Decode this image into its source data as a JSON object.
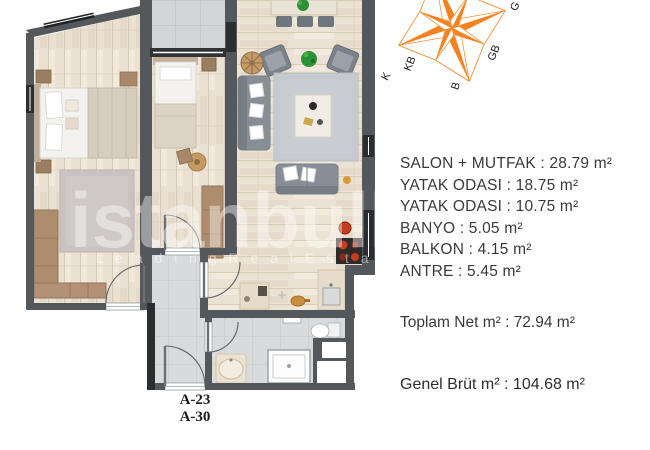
{
  "window": {
    "width": 650,
    "height": 450,
    "background": "#ffffff"
  },
  "floor_plan": {
    "unit_label_line1": "A-23",
    "unit_label_line2": "A-30",
    "watermark_line1": "istanbulh",
    "watermark_line2": "L e a d i n g   R e a l   E s t a",
    "colors": {
      "wall": "#53585c",
      "wall_dark": "#2b2e30",
      "wood_floor": "#ebe1d2",
      "balcony_tile": "#d3d4d6",
      "hall_tile": "#d8dadb",
      "sofa_gray": "#878e96",
      "wardrobe_brown": "#ad8d6d",
      "plant_green": "#2f9135",
      "stove_red": "#c63c20"
    }
  },
  "compass": {
    "color": "#f58220",
    "labels": {
      "k": "K",
      "kb": "KB",
      "b": "B",
      "gb": "GB",
      "g": "G"
    }
  },
  "room_list": {
    "items": [
      "SALON + MUTFAK : 28.79 m²",
      "YATAK ODASI : 18.75 m²",
      "YATAK ODASI : 10.75 m²",
      "BANYO : 5.05 m²",
      "BALKON : 4.15 m²",
      "ANTRE : 5.45 m²"
    ],
    "total_net": "Toplam Net m² : 72.94 m²",
    "total_gross": "Genel Brüt m² : 104.68 m²"
  }
}
